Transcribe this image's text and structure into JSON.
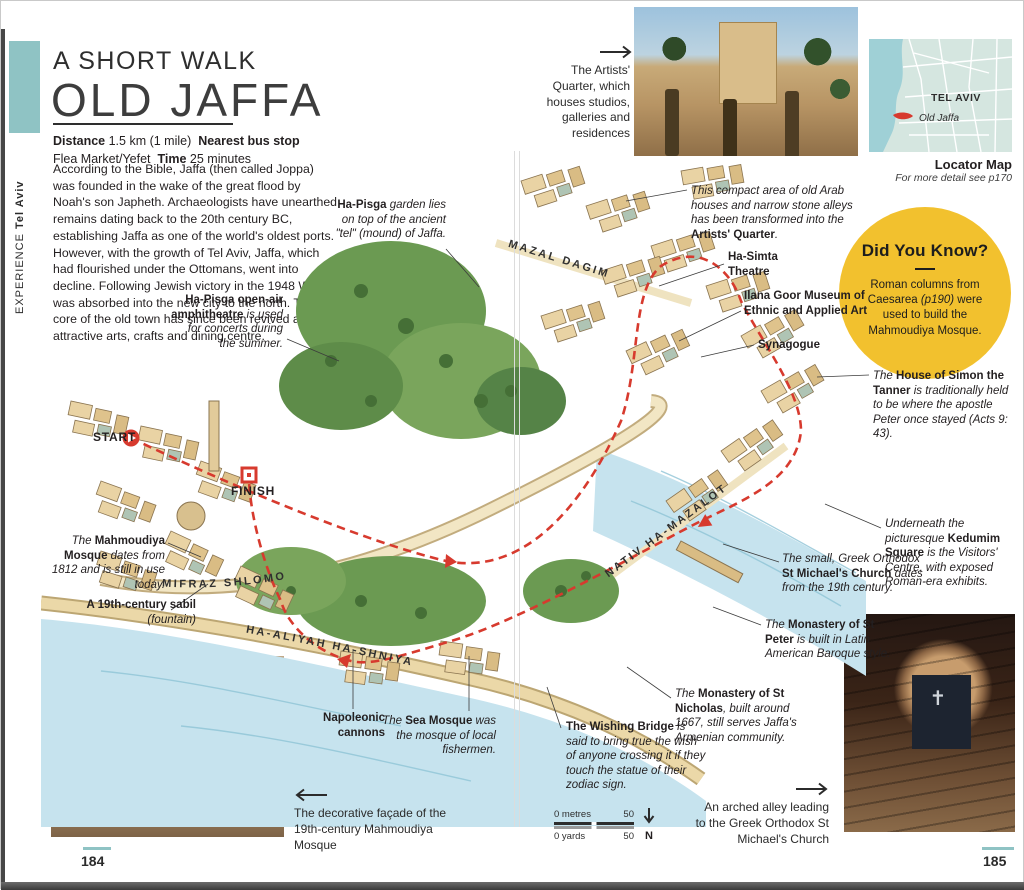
{
  "colors": {
    "accent_teal": "#8FC3C4",
    "didyouknow_yellow": "#F2C12E",
    "route_red": "#D73A2E"
  },
  "sidebar": {
    "section": "EXPERIENCE",
    "region": "Tel Aviv"
  },
  "header": {
    "kicker": "A SHORT WALK",
    "title": "OLD JAFFA"
  },
  "info": {
    "distance_label": "Distance",
    "distance_value": "1.5 km (1 mile)",
    "bus_label": "Nearest bus stop",
    "bus_value": "Flea Market/Yefet",
    "time_label": "Time",
    "time_value": "25 minutes"
  },
  "intro": "According to the Bible, Jaffa (then called Joppa) was founded in the wake of the great flood by Noah's son Japheth. Archaeologists have unearthed remains dating back to the 20th century BC, establishing Jaffa as one of the world's oldest ports. However, with the growth of Tel Aviv, Jaffa, which had flourished under the Ottomans, went into decline. Following Jewish victory in the 1948 War, it was absorbed into the new city to the north. The core of the old town has since been revived as an attractive arts, crafts and dining centre.",
  "photo_captions": {
    "artists_quarter": "The Artists' Quarter, which houses studios, galleries and residences",
    "mahmoudiya_facade": "The decorative façade of the 19th-century Mahmoudiya Mosque",
    "arched_alley": "An arched alley leading to the Greek Orthodox St Michael's Church"
  },
  "locator": {
    "region": "TEL AVIV",
    "marker": "Old Jaffa",
    "title": "Locator Map",
    "subtitle": "For more detail see p170"
  },
  "did_you_know": {
    "title": "Did You Know?",
    "body_pre": "Roman columns from Caesarea ",
    "body_ref": "(p190)",
    "body_post": " were used to build the Mahmoudiya Mosque."
  },
  "map": {
    "start_label": "START",
    "finish_label": "FINISH",
    "streets": {
      "mifraz": "MIFRAZ SHLOMO",
      "mazal": "MAZAL DAGIM",
      "nativ": "NATIV HA-MAZALOT",
      "ha_aliyah": "HA-ALIYAH HA-SHNIYA"
    },
    "annotations": {
      "garden": {
        "pre": "",
        "bold": "Ha-Pisga",
        "post": " garden lies on top of the ancient \"tel\" (mound) of Jaffa."
      },
      "amphitheatre": {
        "pre": "",
        "bold": "Ha-Pisga open-air amphitheatre",
        "post": " is used for concerts during the summer."
      },
      "artists_quarter": {
        "pre": "This compact area of old Arab houses and narrow stone alleys has been transformed into the ",
        "bold": "Artists' Quarter",
        "post": "."
      },
      "ha_simta": {
        "pre": "",
        "bold": "Ha-Simta Theatre",
        "post": ""
      },
      "ilana_goor": {
        "pre": "",
        "bold": "Ilana Goor Museum of Ethnic and Applied Art",
        "post": ""
      },
      "synagogue": {
        "pre": "",
        "bold": "Synagogue",
        "post": ""
      },
      "house_of_simon": {
        "pre": "The ",
        "bold": "House of Simon the Tanner",
        "post": " is traditionally held to be where the apostle Peter once stayed (Acts 9: 43)."
      },
      "kedumim": {
        "pre": "Underneath the picturesque ",
        "bold": "Kedumim Square",
        "post": " is the Visitors' Centre, with exposed Roman-era exhibits."
      },
      "st_michaels": {
        "pre": "The small, Greek Orthodox ",
        "bold": "St Michael's Church",
        "post": " dates from the 19th century."
      },
      "monastery_st_peter": {
        "pre": "The ",
        "bold": "Monastery of St Peter",
        "post": " is built in Latin American Baroque style."
      },
      "monastery_st_nicholas": {
        "pre": "The ",
        "bold": "Monastery of St Nicholas",
        "post": ", built around 1667, still serves Jaffa's Armenian community."
      },
      "wishing_bridge": {
        "pre": "",
        "bold": "The Wishing Bridge",
        "post": " is said to bring true the wish of anyone crossing it if they touch the statue of their zodiac sign."
      },
      "mahmoudiya_mosque": {
        "pre": "The ",
        "bold": "Mahmoudiya Mosque",
        "post": " dates from 1812 and is still in use today."
      },
      "sabil": {
        "pre": "",
        "bold": "A 19th-century sabil",
        "post": " (fountain)"
      },
      "napoleonic_cannons": {
        "pre": "",
        "bold": "Napoleonic cannons",
        "post": ""
      },
      "sea_mosque": {
        "pre": "The ",
        "bold": "Sea Mosque",
        "post": " was the mosque of local fishermen."
      }
    }
  },
  "scale_bar": {
    "metres_label": "0 metres",
    "metres_value": "50",
    "yards_label": "0 yards",
    "yards_value": "50",
    "north": "N"
  },
  "footer": {
    "left_page": "184",
    "right_page": "185"
  }
}
